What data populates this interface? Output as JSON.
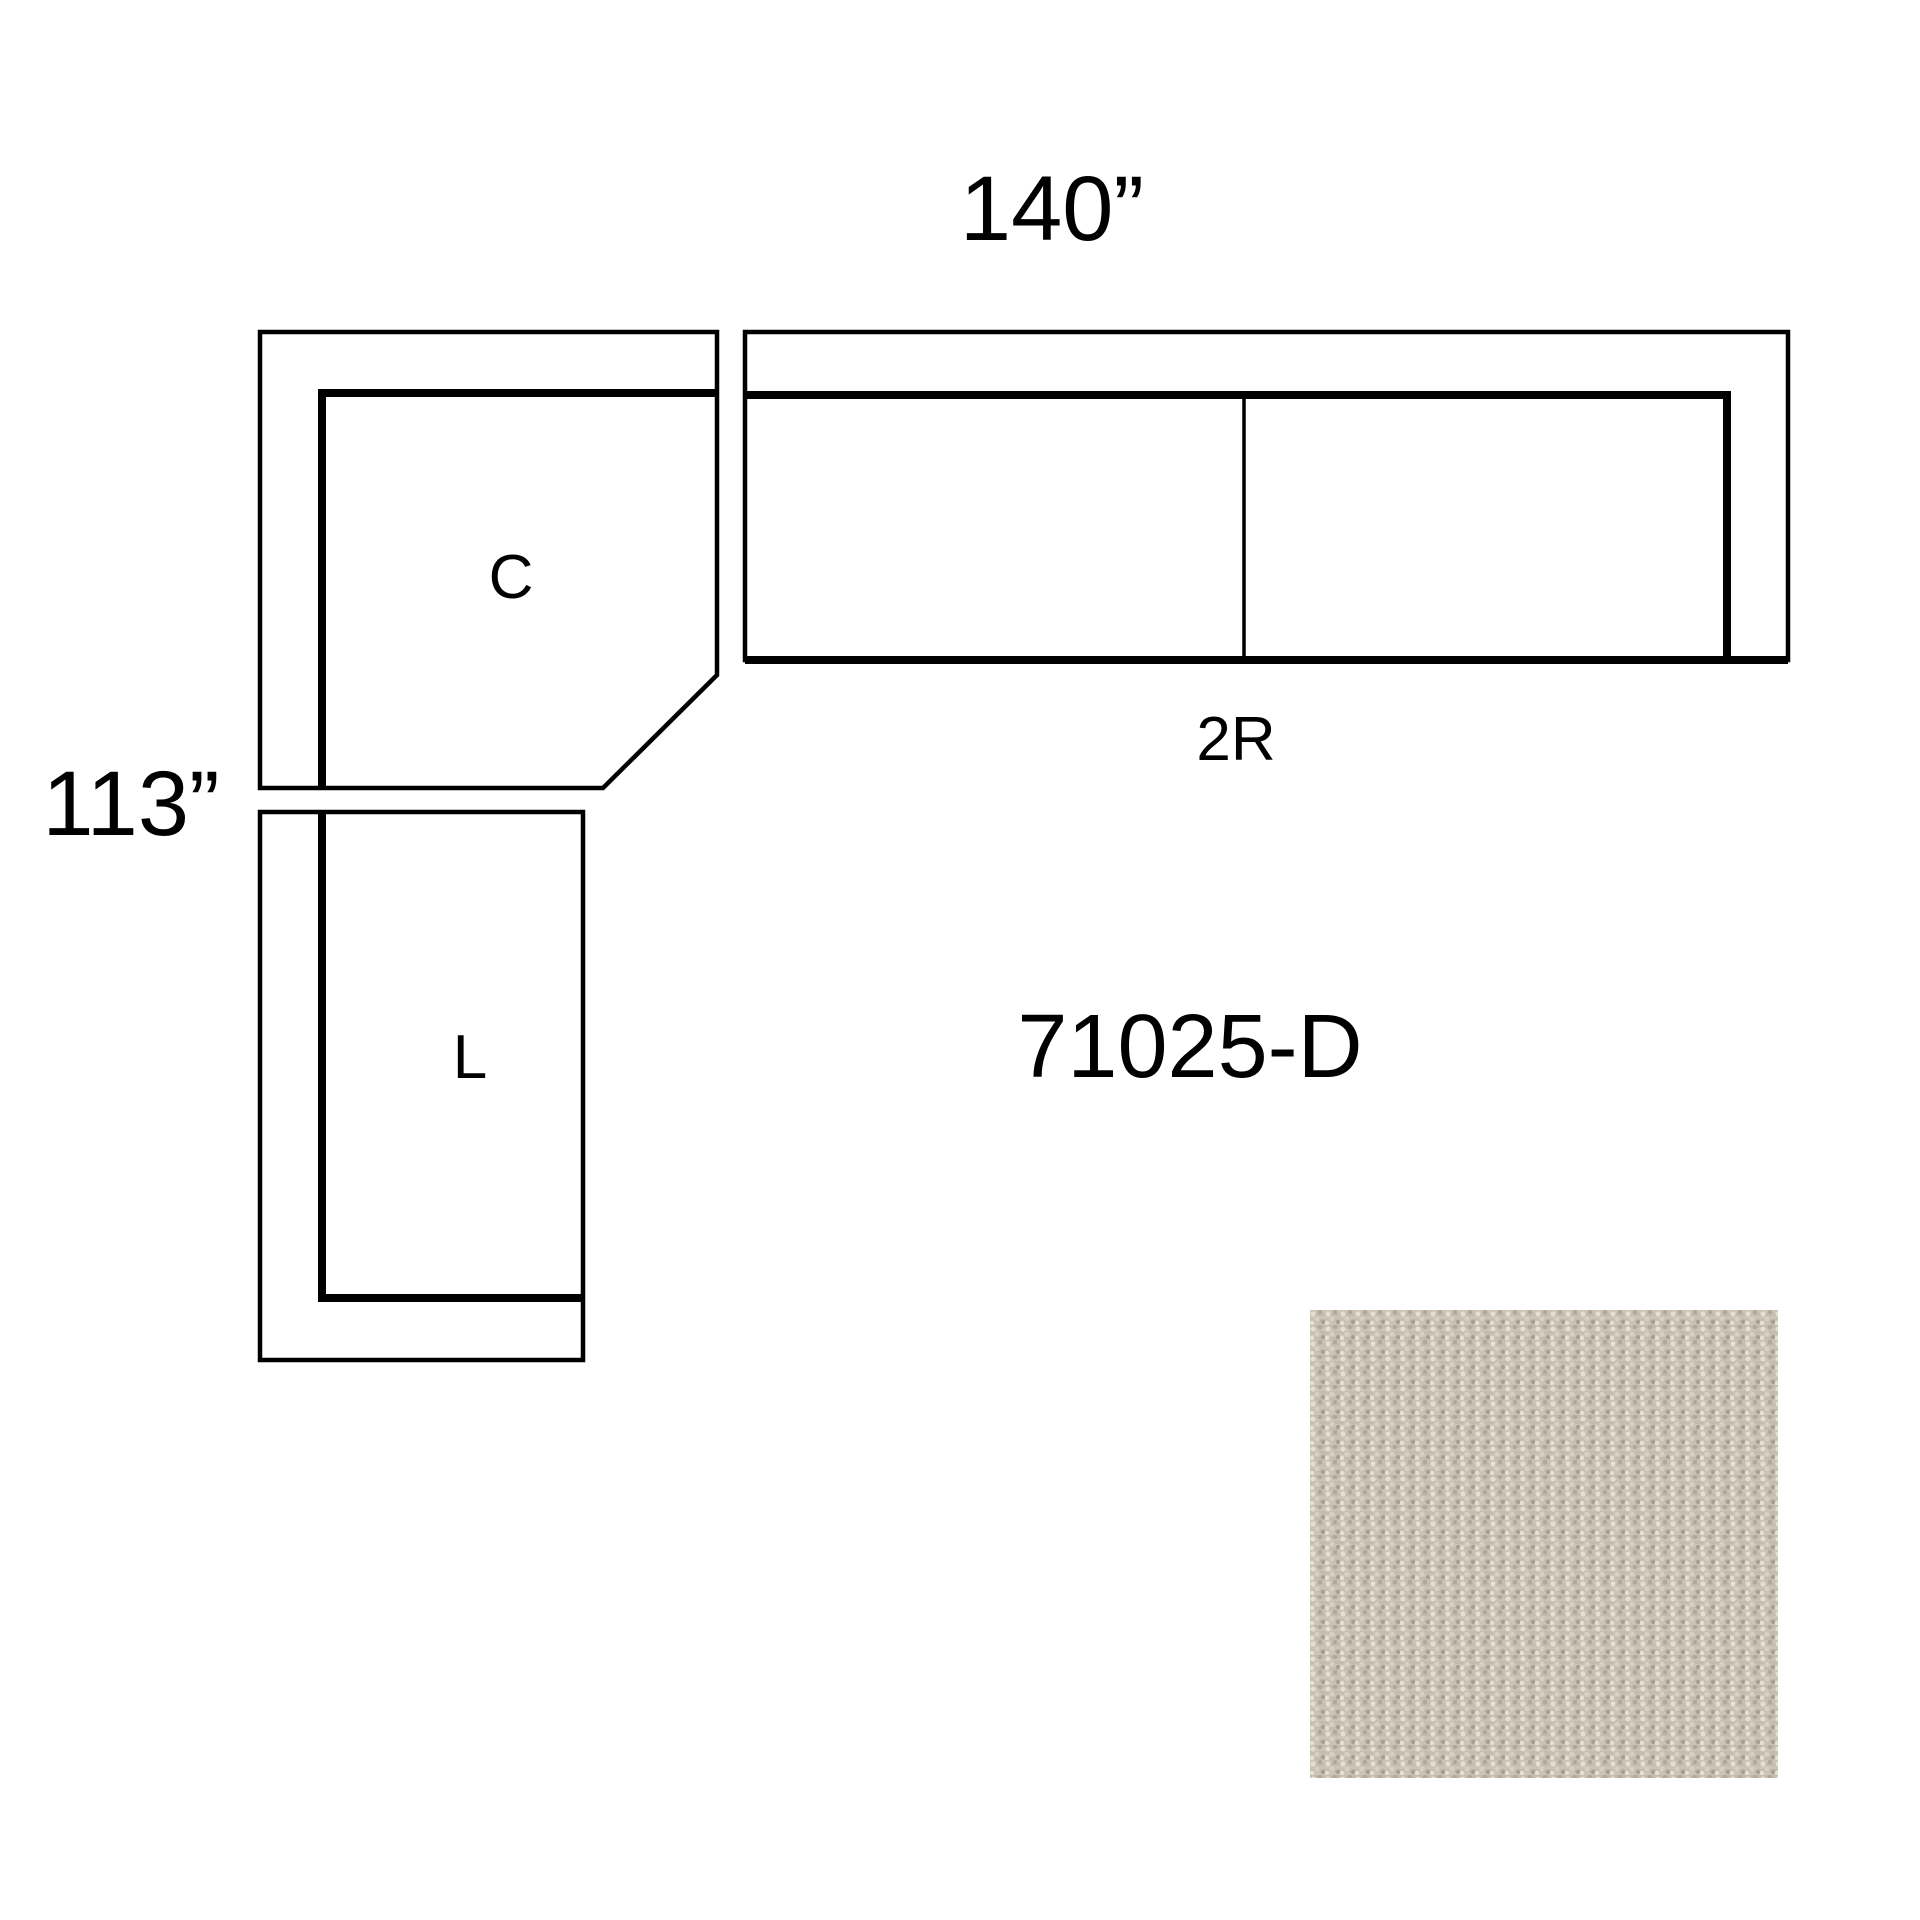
{
  "diagram": {
    "width_label": "140”",
    "height_label": "113”",
    "model_number": "71025-D",
    "sections": {
      "corner": "C",
      "left": "L",
      "right": "2R"
    }
  },
  "theme": {
    "background": "#ffffff",
    "line_color": "#000000",
    "text_color": "#000000",
    "swatch_base": "#c8c0b2",
    "swatch_light": "#e5dfd4",
    "swatch_light_2": "#d8d1c3",
    "swatch_dark": "#b2a897",
    "swatch_dark_2": "#a89d8b"
  }
}
